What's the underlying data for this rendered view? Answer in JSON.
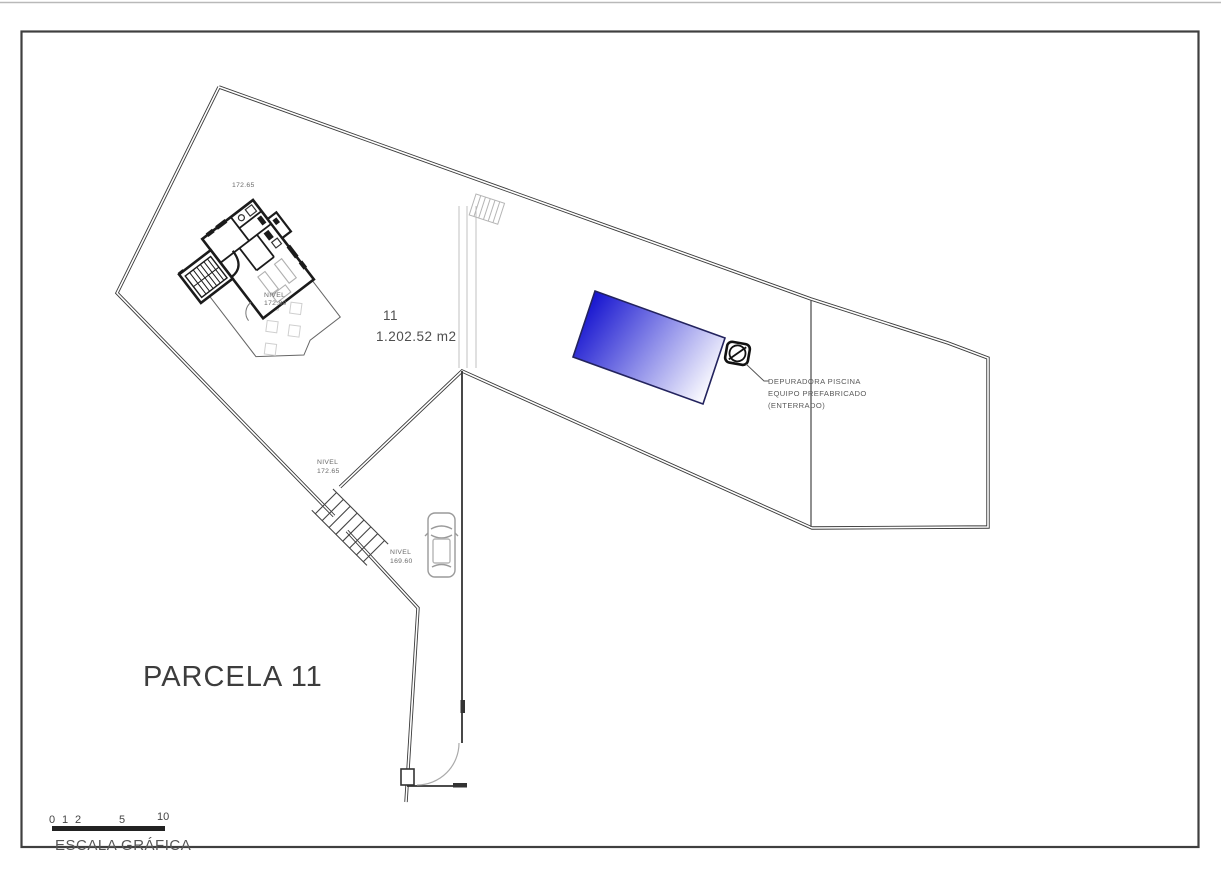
{
  "drawing": {
    "title": "PARCELA 11",
    "parcel": {
      "number": "11",
      "area": "1.202.52 m2"
    },
    "levels": {
      "terrain_top": "172.65",
      "house": {
        "label": "NIVEL",
        "value": "172.80"
      },
      "garden": {
        "label": "NIVEL",
        "value": "172.65"
      },
      "driveway": {
        "label": "NIVEL",
        "value": "169.60"
      }
    },
    "pool_equipment_note": {
      "line1": "DEPURADORA PISCINA",
      "line2": "EQUIPO PREFABRICADO",
      "line3": "(ENTERRADO)"
    },
    "scale_bar": {
      "label": "ESCALA GRÁFICA",
      "ticks": [
        "0",
        "1",
        "2",
        "5",
        "10"
      ]
    },
    "colors": {
      "pool_deep": "#1412cf",
      "pool_mid": "#8a8ae8",
      "pool_shallow": "#ffffff",
      "line": "#3a3a3a"
    }
  }
}
